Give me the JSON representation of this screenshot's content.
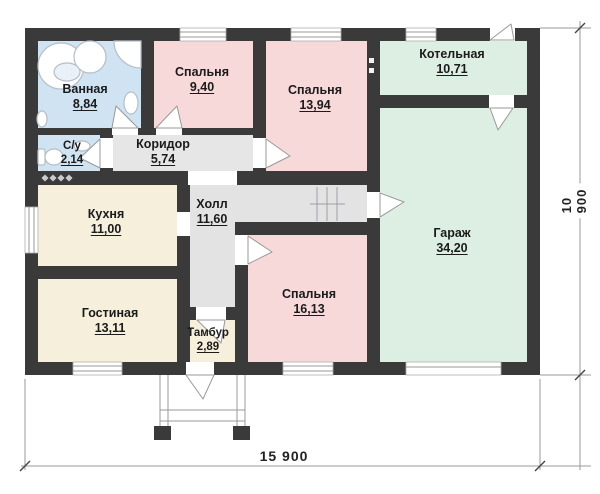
{
  "palette": {
    "wall": "#3a3a3a",
    "bedroom_pink": "#f8d9d9",
    "bathroom_blue": "#cfe3f3",
    "utility_green": "#ddefe3",
    "living_cream": "#f6efdc",
    "hall_gray": "#e3e3e3",
    "fixture_stroke": "#b5bec6"
  },
  "plan": {
    "rooms": [
      {
        "key": "bathroom",
        "name": "Ванная",
        "area": "8,84"
      },
      {
        "key": "wc",
        "name": "С/у",
        "area": "2,14"
      },
      {
        "key": "corridor",
        "name": "Коридор",
        "area": "5,74"
      },
      {
        "key": "bedroom-1",
        "name": "Спальня",
        "area": "9,40"
      },
      {
        "key": "bedroom-2",
        "name": "Спальня",
        "area": "13,94"
      },
      {
        "key": "boiler-room",
        "name": "Котельная",
        "area": "10,71"
      },
      {
        "key": "kitchen",
        "name": "Кухня",
        "area": "11,00"
      },
      {
        "key": "hall",
        "name": "Холл",
        "area": "11,60"
      },
      {
        "key": "living-room",
        "name": "Гостиная",
        "area": "13,11"
      },
      {
        "key": "bedroom-3",
        "name": "Спальня",
        "area": "16,13"
      },
      {
        "key": "vestibule",
        "name": "Тамбур",
        "area": "2,89"
      },
      {
        "key": "garage",
        "name": "Гараж",
        "area": "34,20"
      }
    ],
    "dimensions": {
      "overall_width": "15 900",
      "overall_height": "10 900"
    }
  }
}
